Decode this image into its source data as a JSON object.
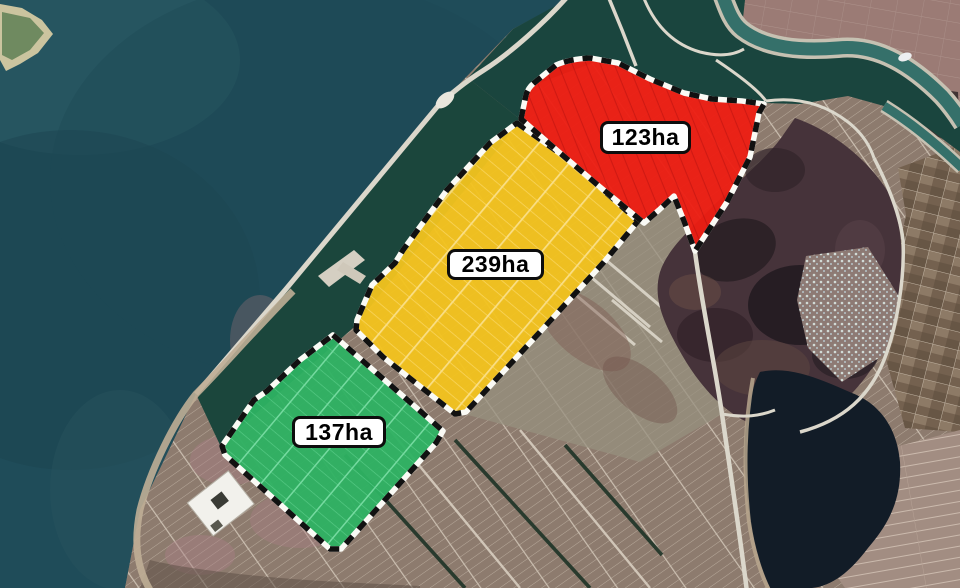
{
  "map": {
    "unit": "ha",
    "zones": [
      {
        "id": "zone-north",
        "label": "123ha",
        "area": 123,
        "color": "#ed1d12"
      },
      {
        "id": "zone-central",
        "label": "239ha",
        "area": 239,
        "color": "#f3c31d"
      },
      {
        "id": "zone-south",
        "label": "137ha",
        "area": 137,
        "color": "#2db262"
      }
    ],
    "palette": {
      "sea": "#1f4c59",
      "inner_basin": "#1a453e",
      "river": "#35706a",
      "farmland": "#8f7c6f",
      "hills": "#46333a",
      "lake": "#121c27",
      "road": "#dbd7cb",
      "zone_border": "#111111",
      "label_background": "#ffffff",
      "label_text": "#000000"
    }
  }
}
